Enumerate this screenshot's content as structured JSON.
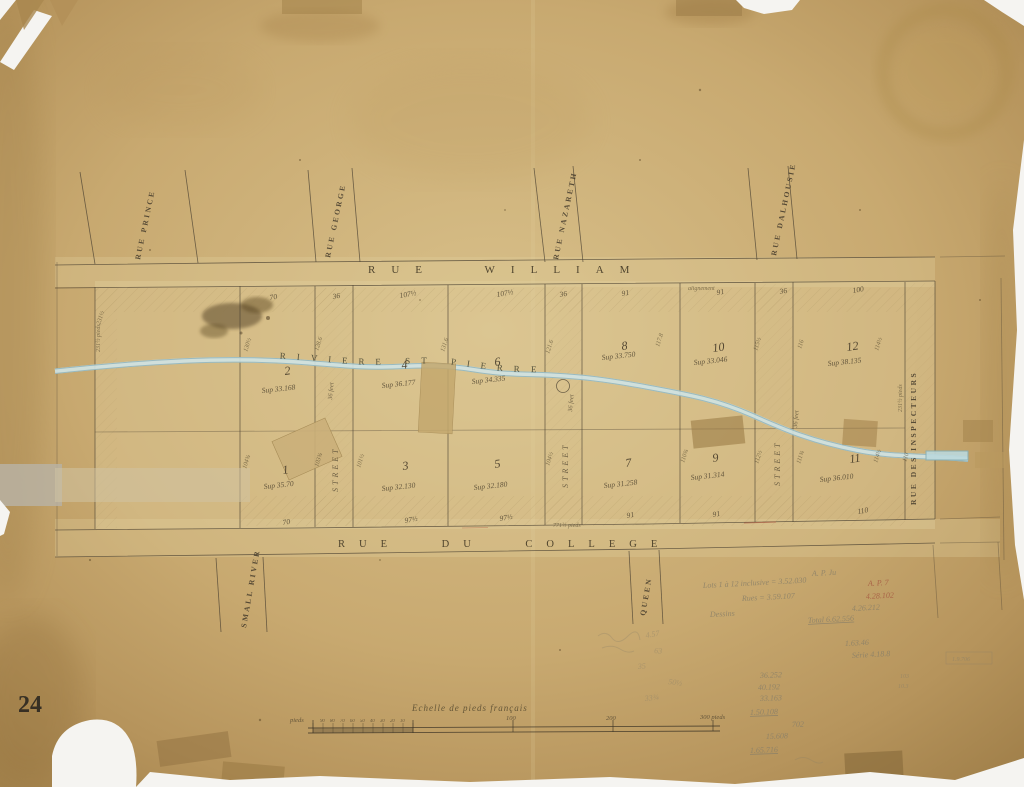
{
  "page": {
    "sheet_number": "24"
  },
  "streets": {
    "main_top": "RUE WILLIAM",
    "main_bottom": "RUE DU COLLEGE",
    "right_vertical": "RUE DES INSPECTEURS",
    "top": [
      {
        "label": "RUE PRINCE"
      },
      {
        "label": "RUE GEORGE"
      },
      {
        "label": "RUE NAZARETH"
      },
      {
        "label": "RUE DALHOUSIE"
      }
    ],
    "bottom": [
      {
        "label": "SMALL RIVER"
      },
      {
        "label": "QUEEN"
      }
    ],
    "corridor_label": "STREET",
    "corridor_width_note": "36 feet"
  },
  "river": {
    "label": "RIVIERE ST PIERRE"
  },
  "lots": [
    {
      "num": "2",
      "sup": "Sup 33.168",
      "nx": 285,
      "ny": 375,
      "sx": 262,
      "sy": 393
    },
    {
      "num": "4",
      "sup": "Sup 36.177",
      "nx": 402,
      "ny": 369,
      "sx": 382,
      "sy": 388
    },
    {
      "num": "6",
      "sup": "Sup 34.335",
      "nx": 495,
      "ny": 366,
      "sx": 472,
      "sy": 384
    },
    {
      "num": "8",
      "sup": "Sup 33.750",
      "nx": 622,
      "ny": 350,
      "sx": 602,
      "sy": 360
    },
    {
      "num": "10",
      "sup": "Sup 33.046",
      "nx": 713,
      "ny": 352,
      "sx": 694,
      "sy": 365
    },
    {
      "num": "12",
      "sup": "Sup 38.135",
      "nx": 847,
      "ny": 351,
      "sx": 828,
      "sy": 366
    },
    {
      "num": "1",
      "sup": "Sup 35.70",
      "nx": 283,
      "ny": 474,
      "sx": 264,
      "sy": 489
    },
    {
      "num": "3",
      "sup": "Sup 32.130",
      "nx": 403,
      "ny": 470,
      "sx": 382,
      "sy": 491
    },
    {
      "num": "5",
      "sup": "Sup 32.180",
      "nx": 495,
      "ny": 468,
      "sx": 474,
      "sy": 490
    },
    {
      "num": "7",
      "sup": "Sup 31.258",
      "nx": 626,
      "ny": 467,
      "sx": 604,
      "sy": 488
    },
    {
      "num": "9",
      "sup": "Sup 31.314",
      "nx": 713,
      "ny": 462,
      "sx": 691,
      "sy": 480
    },
    {
      "num": "11",
      "sup": "Sup 36.010",
      "nx": 850,
      "ny": 463,
      "sx": 820,
      "sy": 482
    }
  ],
  "measurements": {
    "top_row": [
      {
        "v": "70",
        "x": 270
      },
      {
        "v": "36",
        "x": 333
      },
      {
        "v": "107½",
        "x": 400
      },
      {
        "v": "107½",
        "x": 497
      },
      {
        "v": "36",
        "x": 560
      },
      {
        "v": "91",
        "x": 622
      },
      {
        "v": "91",
        "x": 717
      },
      {
        "v": "36",
        "x": 780
      },
      {
        "v": "100",
        "x": 853
      }
    ],
    "bottom_row": [
      {
        "v": "70",
        "x": 283
      },
      {
        "v": "97½",
        "x": 405
      },
      {
        "v": "97½",
        "x": 500
      },
      {
        "v": "91",
        "x": 627
      },
      {
        "v": "91",
        "x": 713
      },
      {
        "v": "110",
        "x": 858
      }
    ],
    "side": [
      {
        "v": "231½",
        "x": 100,
        "y": 325
      },
      {
        "v": "130½",
        "x": 247,
        "y": 352
      },
      {
        "v": "128.6",
        "x": 318,
        "y": 351
      },
      {
        "v": "131.6",
        "x": 444,
        "y": 352
      },
      {
        "v": "121.6",
        "x": 549,
        "y": 354
      },
      {
        "v": "117.8",
        "x": 659,
        "y": 347
      },
      {
        "v": "115½",
        "x": 757,
        "y": 351
      },
      {
        "v": "116",
        "x": 801,
        "y": 349
      },
      {
        "v": "114½",
        "x": 878,
        "y": 351
      },
      {
        "v": "104¾",
        "x": 246,
        "y": 469
      },
      {
        "v": "103¾",
        "x": 318,
        "y": 467
      },
      {
        "v": "101½",
        "x": 360,
        "y": 468
      },
      {
        "v": "104½",
        "x": 549,
        "y": 466
      },
      {
        "v": "110¾",
        "x": 684,
        "y": 463
      },
      {
        "v": "112½",
        "x": 758,
        "y": 464
      },
      {
        "v": "111¾",
        "x": 800,
        "y": 464
      },
      {
        "v": "114½",
        "x": 877,
        "y": 463
      },
      {
        "v": "110",
        "x": 906,
        "y": 462
      }
    ],
    "length_note": "771½ pieds",
    "alignment_note": "alignement",
    "edge_note": "231½ pieds"
  },
  "scale_bar": {
    "title": "Echelle de pieds français",
    "unit": "pieds",
    "major_ticks": [
      "100",
      "200",
      "300 pieds"
    ],
    "minor_ticks": [
      "90",
      "80",
      "70",
      "60",
      "50",
      "40",
      "30",
      "20",
      "10"
    ]
  },
  "annotations": {
    "pencil_notes": [
      {
        "t": "A. P. Ju",
        "x": 812,
        "y": 576,
        "c": ""
      },
      {
        "t": "Lots 1 à 12 inclusive = 3.52.030",
        "x": 703,
        "y": 588,
        "c": ""
      },
      {
        "t": "A. P. 7",
        "x": 868,
        "y": 586,
        "c": "red"
      },
      {
        "t": "Rues = 3.59.107",
        "x": 742,
        "y": 601,
        "c": ""
      },
      {
        "t": "4.28.102",
        "x": 866,
        "y": 599,
        "c": "red"
      },
      {
        "t": "4.26.212",
        "x": 852,
        "y": 611,
        "c": ""
      },
      {
        "t": "Dessins",
        "x": 710,
        "y": 617,
        "c": ""
      },
      {
        "t": "Total 6.62.556",
        "x": 808,
        "y": 623,
        "c": "",
        "u": true
      },
      {
        "t": "1.63.46",
        "x": 845,
        "y": 646,
        "c": ""
      },
      {
        "t": "Série 4.18.8",
        "x": 852,
        "y": 658,
        "c": ""
      }
    ],
    "pencil_column": [
      {
        "t": "36.252",
        "x": 760,
        "y": 678
      },
      {
        "t": "40.192",
        "x": 758,
        "y": 690
      },
      {
        "t": "33.163",
        "x": 760,
        "y": 701
      },
      {
        "t": "1.50.108",
        "x": 750,
        "y": 715,
        "u": true
      },
      {
        "t": "702",
        "x": 792,
        "y": 727
      },
      {
        "t": "15.608",
        "x": 766,
        "y": 739
      },
      {
        "t": "1.65.716",
        "x": 750,
        "y": 753,
        "u": true
      }
    ],
    "scribbles": [
      {
        "t": "4.57",
        "x": 646,
        "y": 638
      },
      {
        "t": "63",
        "x": 654,
        "y": 653
      },
      {
        "t": "35",
        "x": 638,
        "y": 669
      },
      {
        "t": "50½",
        "x": 668,
        "y": 684
      },
      {
        "t": "33¾",
        "x": 645,
        "y": 701
      }
    ],
    "corner_tiny": [
      {
        "t": "1.9.706",
        "x": 952,
        "y": 661
      },
      {
        "t": "103",
        "x": 900,
        "y": 678
      },
      {
        "t": "10.3",
        "x": 898,
        "y": 688
      }
    ]
  }
}
